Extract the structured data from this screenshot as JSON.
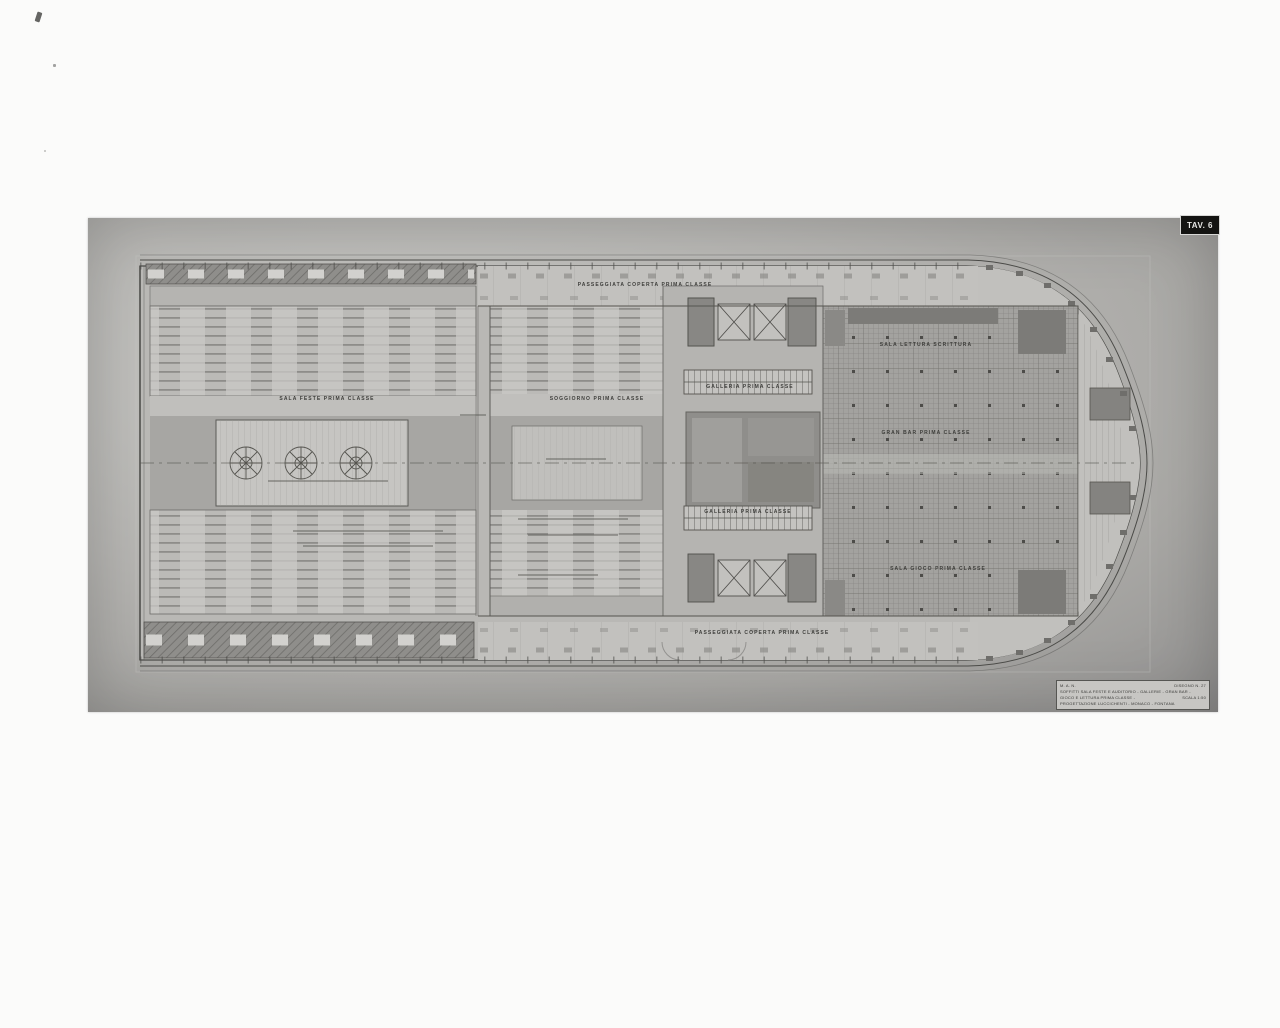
{
  "photo": {
    "tav_tab": "TAV. 6"
  },
  "plan_labels": {
    "sala_feste": "SALA FESTE PRIMA CLASSE",
    "soggiorno": "SOGGIORNO PRIMA CLASSE",
    "galleria_top": "GALLERIA PRIMA CLASSE",
    "galleria_bottom": "GALLERIA PRIMA CLASSE",
    "sala_lettura": "SALA LETTURA SCRITTURA",
    "gran_bar": "GRAN BAR PRIMA CLASSE",
    "sala_gioco": "SALA GIOCO PRIMA CLASSE",
    "passeggiata_top": "PASSEGGIATA COPERTA PRIMA CLASSE",
    "passeggiata_bottom": "PASSEGGIATA COPERTA PRIMA CLASSE"
  },
  "title_block": {
    "line1_left": "M. A. N.",
    "line1_right": "DISEGNO N. 27",
    "line2": "SOFFITTI SALA FESTE E AUDITORIO - GALLERIE - GRAN BAR -",
    "line3_left": "GIOCO E LETTURA PRIMA CLASSE -",
    "line3_right": "SCALA 1:50",
    "line4": "PROGETTAZIONE LUCCICHENTI - MONACO - FONTANA"
  },
  "colors": {
    "photo_gray": "#b3b2af",
    "ink": "#3c3c3a",
    "dark_fill": "#82817e",
    "tab_bg": "#141412"
  }
}
